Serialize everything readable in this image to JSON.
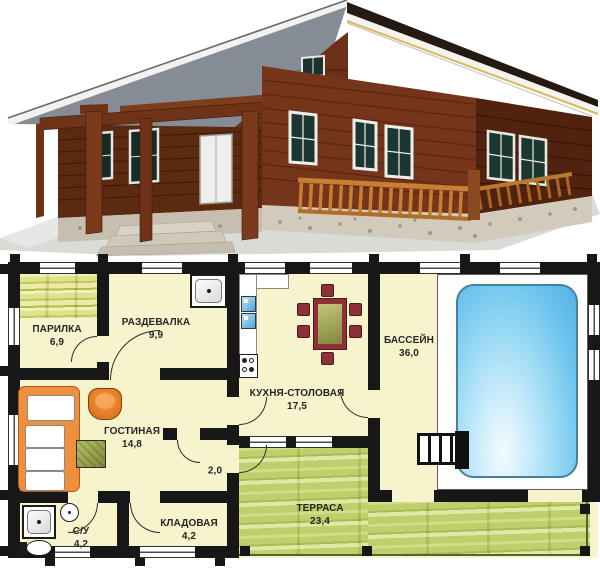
{
  "floor_plan": {
    "rooms": [
      {
        "name": "parilka",
        "label": "ПАРИЛКА",
        "area": "6,9"
      },
      {
        "name": "razdevalka",
        "label": "РАЗДЕВАЛКА",
        "area": "9,9"
      },
      {
        "name": "kuhnya-stolovaya",
        "label": "КУХНЯ-СТОЛОВАЯ",
        "area": "17,5"
      },
      {
        "name": "bassein",
        "label": "БАССЕЙН",
        "area": "36,0"
      },
      {
        "name": "gostinaya",
        "label": "ГОСТИНАЯ",
        "area": "14,8"
      },
      {
        "name": "hall",
        "label": "",
        "area": "2,0"
      },
      {
        "name": "kladovaya",
        "label": "КЛАДОВАЯ",
        "area": "4,2"
      },
      {
        "name": "su",
        "label": "С/У",
        "area": "4,2"
      },
      {
        "name": "terrasa",
        "label": "ТЕРРАСА",
        "area": "23,4"
      }
    ],
    "colors": {
      "floor": "#f6f3cd",
      "walls": "#171717",
      "pool_water": "#6ec5ee",
      "terrace_wood": "#b9c95c",
      "sauna_bench_wood": "#d9dd7a",
      "sofa_armchair_accent": "#ee8f3e",
      "dining_chair_red": "#8e3039",
      "appliance_blue": "#6fc0e4"
    }
  },
  "house_render": {
    "colors": {
      "roof_underside_gray": "#868c96",
      "log_wall_brown": "#74351a",
      "trim_white": "#f4f3ef",
      "fascia_yellow": "#d9b95b",
      "railing_orange": "#c87f33",
      "foundation_stone": "#d2cbbc"
    }
  }
}
